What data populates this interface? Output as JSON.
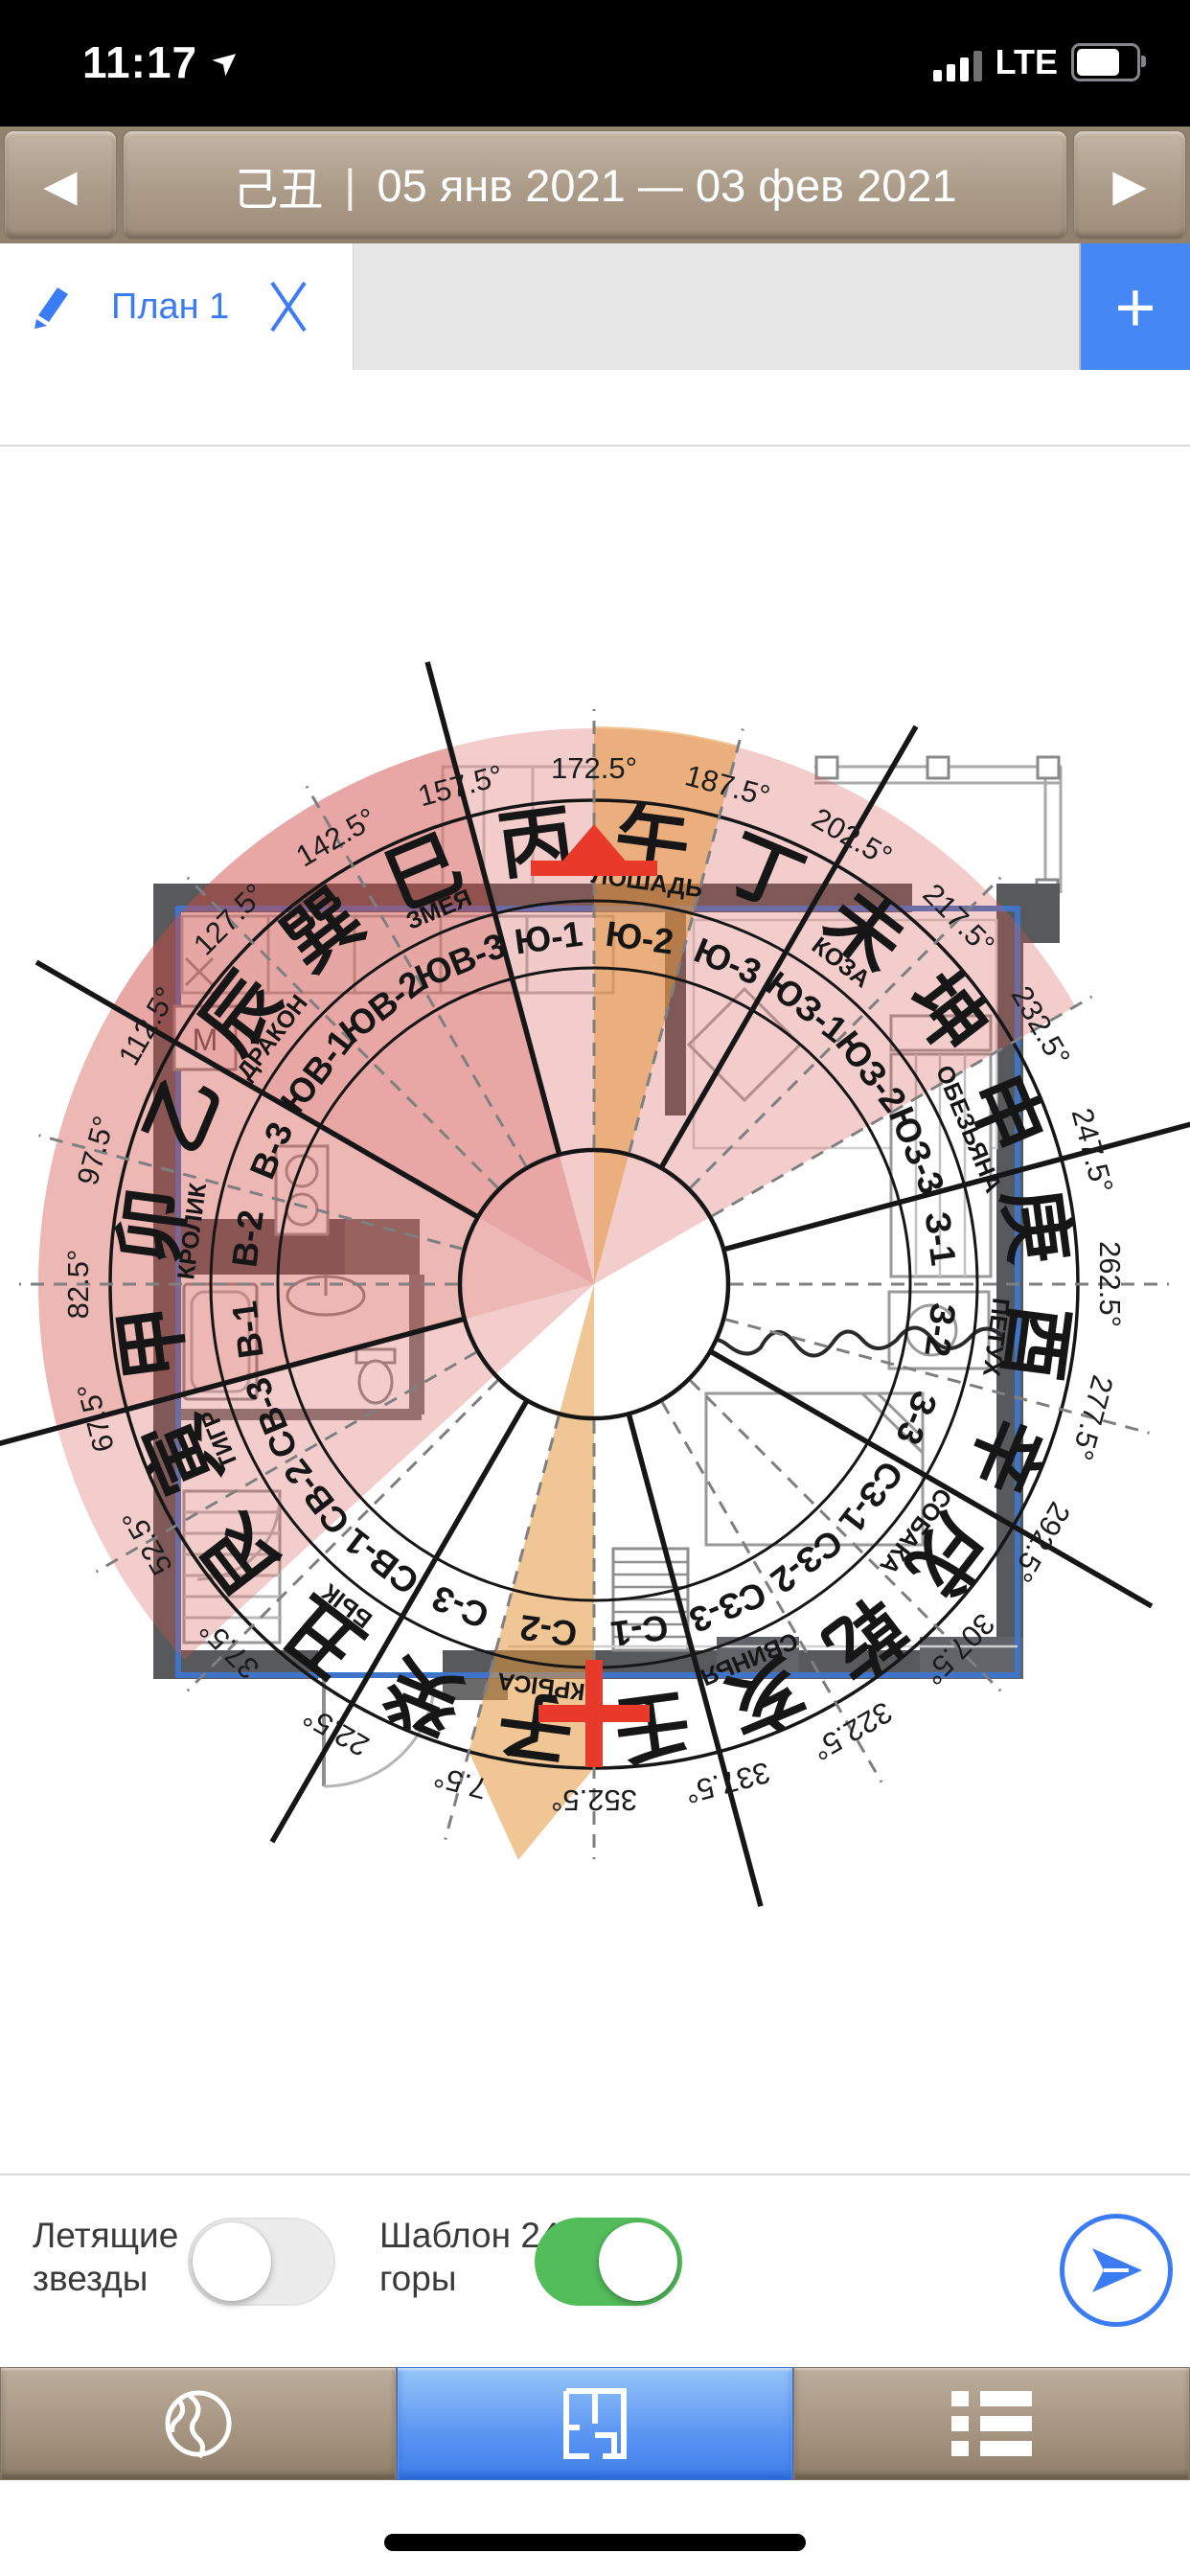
{
  "status_bar": {
    "time": "11:17",
    "network": "LTE"
  },
  "header": {
    "prev_label": "◀",
    "next_label": "▶",
    "period_hanzi": "己丑",
    "separator": "|",
    "date_range": "05 янв 2021 — 03 фев 2021"
  },
  "tab_bar": {
    "active_tab": "План 1",
    "add_button": "+"
  },
  "plan": {
    "washer_label": "М"
  },
  "compass": {
    "colors": {
      "pink": "rgba(216,90,84,0.30)",
      "pink_mid": "rgba(205,70,64,0.16)",
      "pink_dark": "rgba(200,60,55,0.12)",
      "orange": "rgba(225,152,60,0.55)",
      "marker_red": "#e8392a",
      "line": "#161616",
      "dash": "#7f7f7f",
      "outline_blue": "#3f74c8"
    },
    "mountains": [
      {
        "bearing": 345,
        "sector": "С-1",
        "hanzi": "壬"
      },
      {
        "bearing": 0,
        "sector": "С-2",
        "hanzi": "子"
      },
      {
        "bearing": 15,
        "sector": "С-3",
        "hanzi": "癸"
      },
      {
        "bearing": 30,
        "sector": "СВ-1",
        "hanzi": "丑"
      },
      {
        "bearing": 45,
        "sector": "СВ-2",
        "hanzi": "艮"
      },
      {
        "bearing": 60,
        "sector": "СВ-3",
        "hanzi": "寅"
      },
      {
        "bearing": 75,
        "sector": "В-1",
        "hanzi": "甲"
      },
      {
        "bearing": 90,
        "sector": "В-2",
        "hanzi": "卯"
      },
      {
        "bearing": 105,
        "sector": "В-3",
        "hanzi": "乙"
      },
      {
        "bearing": 120,
        "sector": "ЮВ-1",
        "hanzi": "辰"
      },
      {
        "bearing": 135,
        "sector": "ЮВ-2",
        "hanzi": "巽"
      },
      {
        "bearing": 150,
        "sector": "ЮВ-3",
        "hanzi": "巳"
      },
      {
        "bearing": 165,
        "sector": "Ю-1",
        "hanzi": "丙"
      },
      {
        "bearing": 180,
        "sector": "Ю-2",
        "hanzi": "午"
      },
      {
        "bearing": 195,
        "sector": "Ю-3",
        "hanzi": "丁"
      },
      {
        "bearing": 210,
        "sector": "ЮЗ-1",
        "hanzi": "未"
      },
      {
        "bearing": 225,
        "sector": "ЮЗ-2",
        "hanzi": "坤"
      },
      {
        "bearing": 240,
        "sector": "ЮЗ-3",
        "hanzi": "申"
      },
      {
        "bearing": 255,
        "sector": "З-1",
        "hanzi": "庚"
      },
      {
        "bearing": 270,
        "sector": "З-2",
        "hanzi": "酉"
      },
      {
        "bearing": 285,
        "sector": "З-3",
        "hanzi": "辛"
      },
      {
        "bearing": 300,
        "sector": "СЗ-1",
        "hanzi": "戌"
      },
      {
        "bearing": 315,
        "sector": "СЗ-2",
        "hanzi": "乾"
      },
      {
        "bearing": 330,
        "sector": "СЗ-3",
        "hanzi": "亥"
      }
    ],
    "animals": [
      {
        "bearing": 0,
        "name": "КРЫСА"
      },
      {
        "bearing": 30,
        "name": "БЫК"
      },
      {
        "bearing": 60,
        "name": "ТИГР"
      },
      {
        "bearing": 90,
        "name": "КРОЛИК"
      },
      {
        "bearing": 120,
        "name": "ДРАКОН"
      },
      {
        "bearing": 150,
        "name": "ЗМЕЯ"
      },
      {
        "bearing": 180,
        "name": "ЛОШАДЬ"
      },
      {
        "bearing": 210,
        "name": "КОЗА"
      },
      {
        "bearing": 240,
        "name": "ОБЕЗЬЯНА"
      },
      {
        "bearing": 270,
        "name": "ПЕТУХ"
      },
      {
        "bearing": 300,
        "name": "СОБАКА"
      },
      {
        "bearing": 330,
        "name": "СВИНЬЯ"
      }
    ],
    "degree_labels": [
      "7.5°",
      "22.5°",
      "37.5°",
      "52.5°",
      "67.5°",
      "82.5°",
      "97.5°",
      "112.5°",
      "127.5°",
      "142.5°",
      "157.5°",
      "172.5°",
      "187.5°",
      "202.5°",
      "217.5°",
      "232.5°",
      "247.5°",
      "262.5°",
      "277.5°",
      "292.5°",
      "307.5°",
      "322.5°",
      "337.5°",
      "352.5°"
    ],
    "shading": [
      {
        "from": 40,
        "to": 232.5
      },
      {
        "from": 67.5,
        "to": 157.5
      },
      {
        "from": 112.5,
        "to": 157.5
      }
    ],
    "facing_wedges": [
      {
        "from": 172.5,
        "to": 187.5,
        "pointed": false
      },
      {
        "from": 352.5,
        "to": 7.5,
        "pointed": true
      }
    ],
    "markers": {
      "facing_bearing": 172.5,
      "sitting_bearing": 352.5
    }
  },
  "controls": {
    "flying_stars_label": "Летящие звезды",
    "flying_stars_on": false,
    "template_label": "Шаблон 24 горы",
    "template_on": true
  },
  "toolbar": {
    "items": [
      "globe",
      "floor-plan",
      "list"
    ],
    "active": "floor-plan"
  }
}
